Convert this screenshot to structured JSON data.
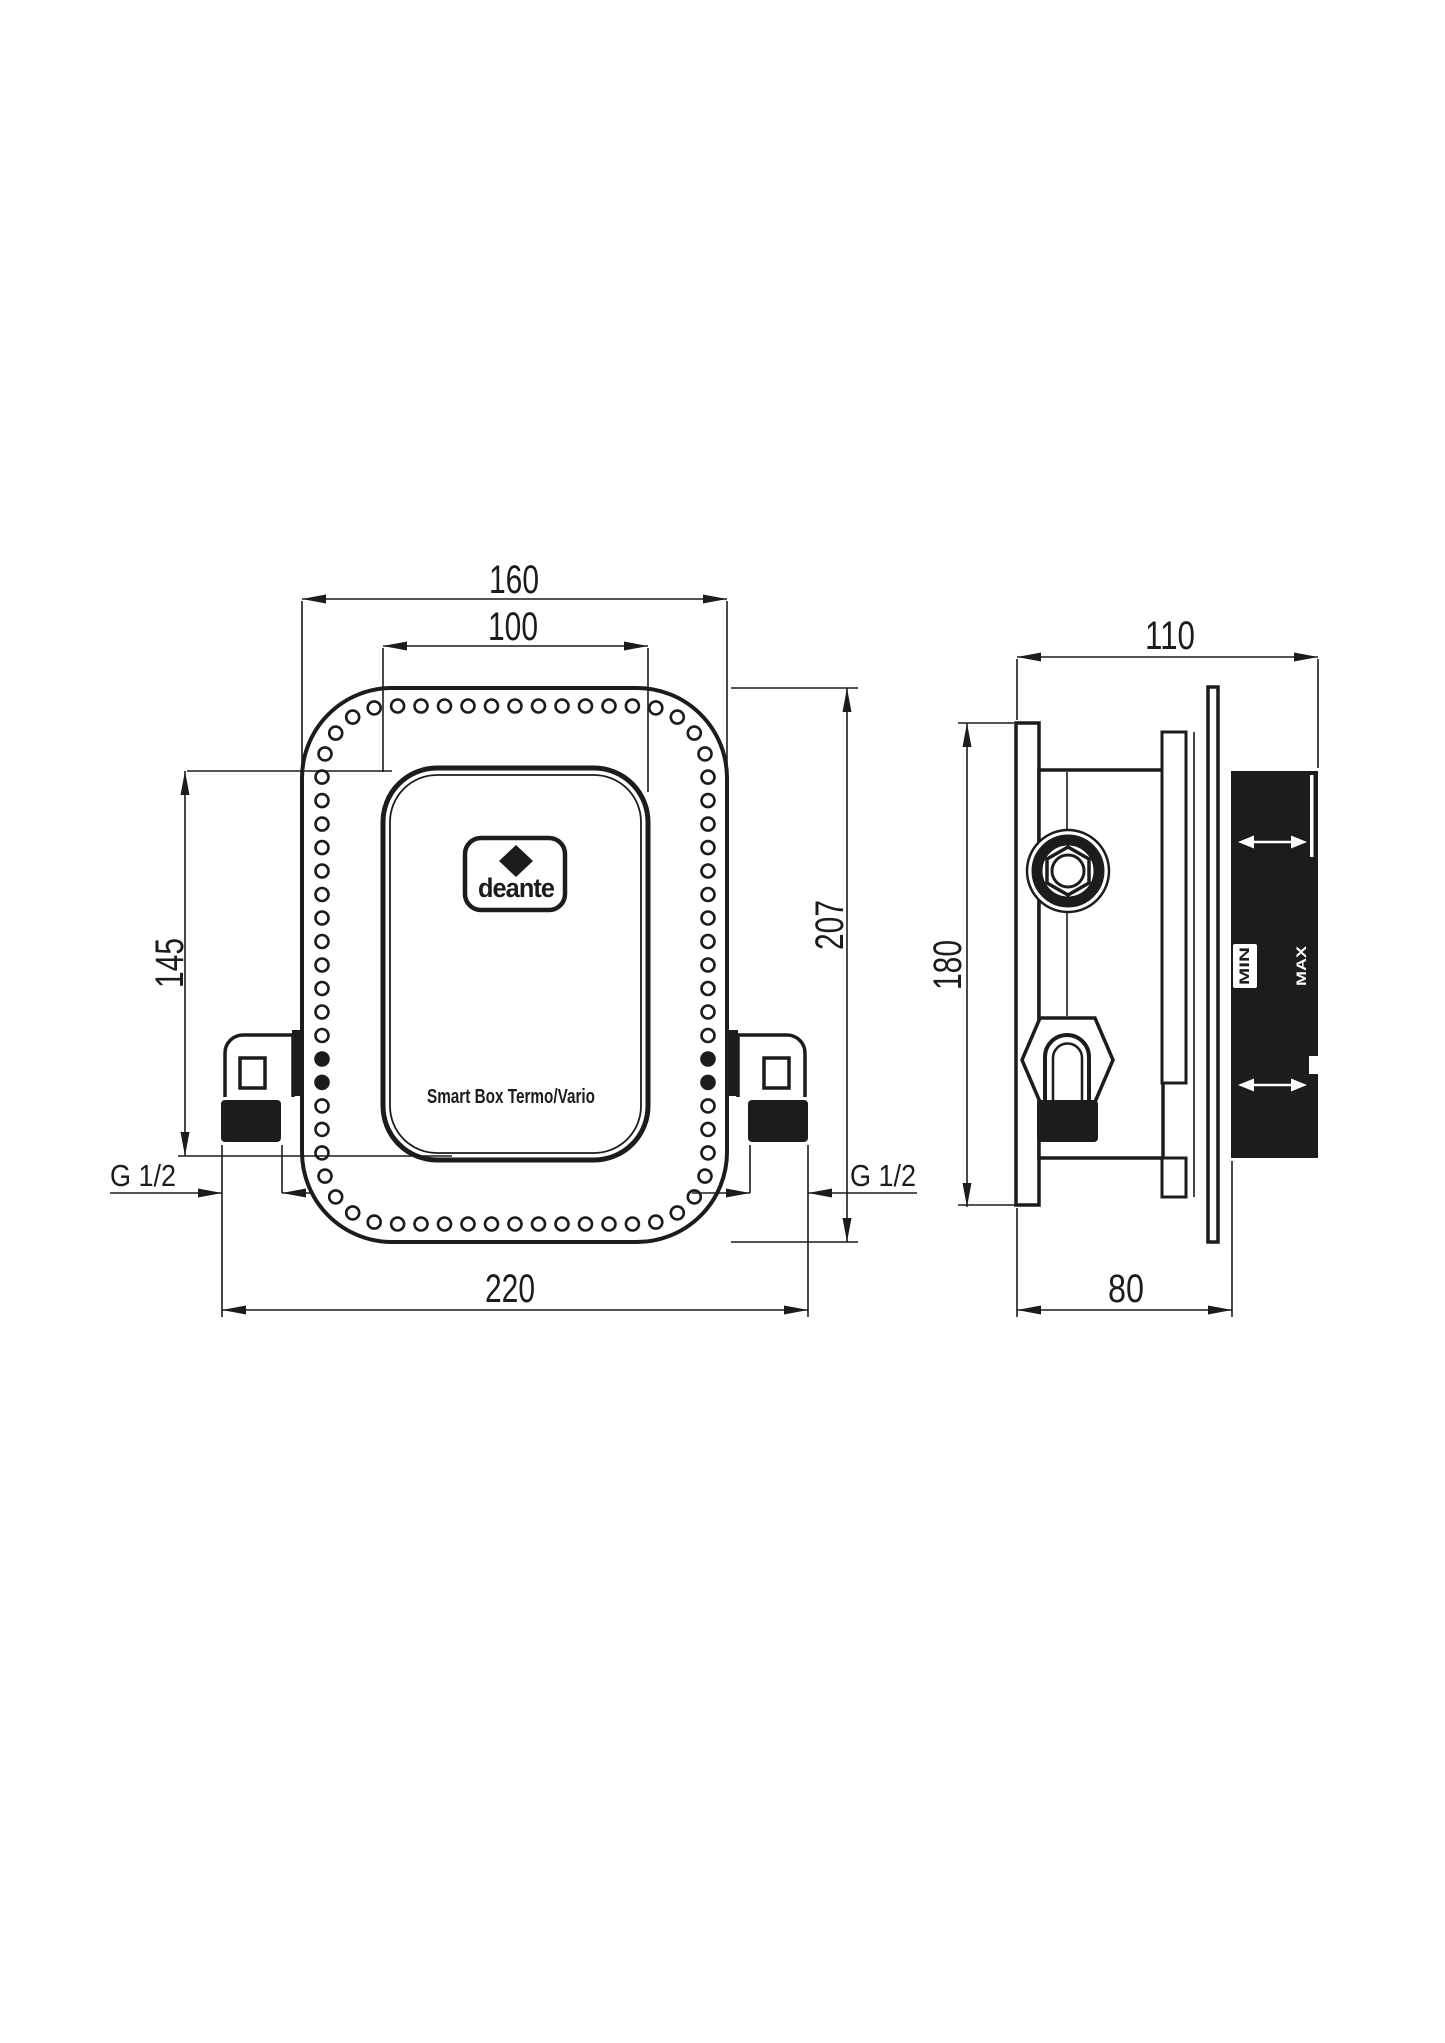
{
  "drawing": {
    "brand": "deante",
    "product_label": "Smart Box Termo/Vario",
    "colors": {
      "ink": "#1c1c1c",
      "paper": "#ffffff"
    },
    "front_view": {
      "dim_outer_width": "160",
      "dim_cover_width": "100",
      "dim_cover_height": "145",
      "dim_outer_height": "207",
      "dim_connections_span": "220",
      "thread_left": "G 1/2",
      "thread_right": "G 1/2"
    },
    "side_view": {
      "dim_total_depth": "110",
      "dim_flange_height": "180",
      "dim_box_depth": "80",
      "marking_min": "MIN",
      "marking_max": "MAX"
    }
  }
}
